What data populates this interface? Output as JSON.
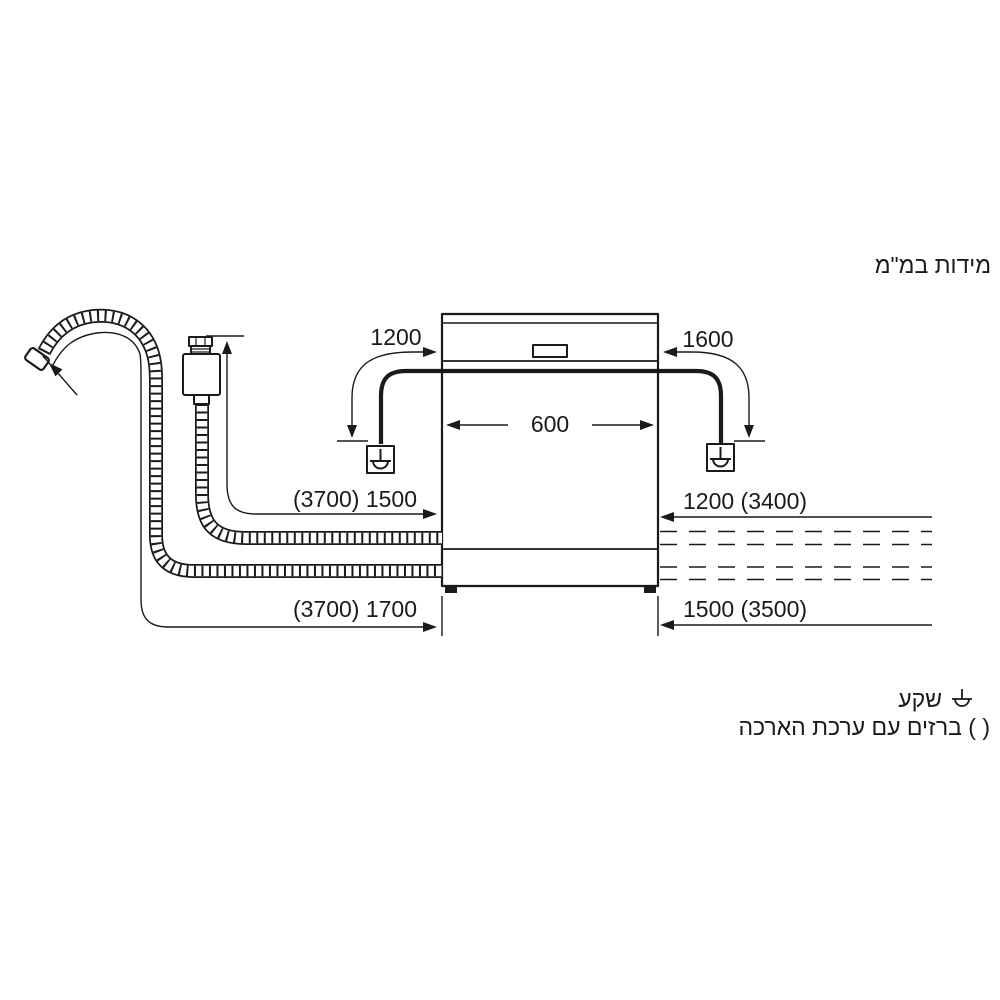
{
  "title": "מידות במ\"מ",
  "dimensions": {
    "socket_left_distance": "1200",
    "socket_right_distance": "1600",
    "appliance_width": "600",
    "inlet_hose_length": "(3700) 1500",
    "right_upper_length": "1200 (3400)",
    "drain_hose_length": "(3700) 1700",
    "right_lower_length": "1500 (3500)"
  },
  "legend": {
    "socket_label": "שקע",
    "parentheses_label": "( ) ברזים עם ערכת הארכה"
  },
  "icons": {
    "socket_symbol": "power-socket-symbol"
  },
  "colors": {
    "ink": "#1a1a1a",
    "background": "#ffffff"
  }
}
